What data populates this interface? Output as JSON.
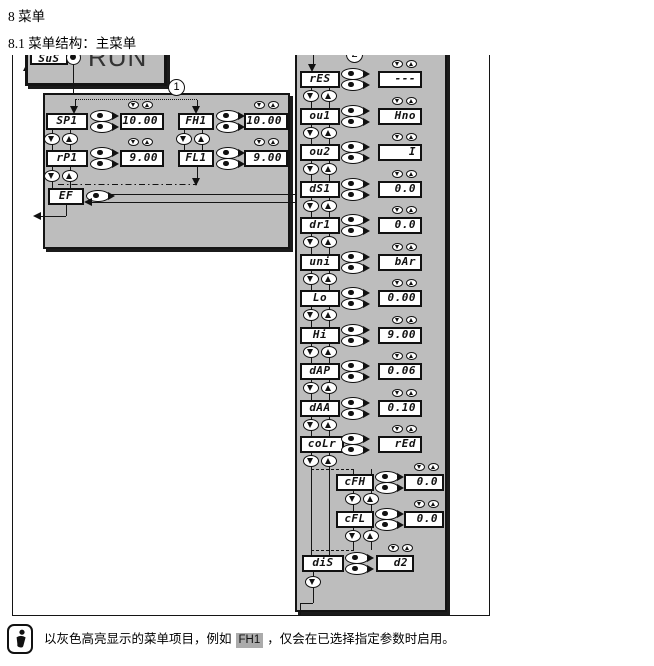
{
  "page": {
    "heading1": "8 菜单",
    "heading2": "8.1 菜单结构：主菜单"
  },
  "diagram": {
    "run_screen": {
      "menu_label": "SuS",
      "display": "RUN"
    },
    "callouts": {
      "one": "1",
      "two": "2"
    },
    "init_menu": {
      "rows": [
        {
          "label": "SP1",
          "value": "10.00"
        },
        {
          "label": "FH1",
          "value": "10.00"
        },
        {
          "label": "rP1",
          "value": "9.00"
        },
        {
          "label": "FL1",
          "value": "9.00"
        }
      ],
      "ef_label": "EF"
    },
    "ext_menu": {
      "rows": [
        {
          "label": "rES",
          "value": "---"
        },
        {
          "label": "ou1",
          "value": "Hno"
        },
        {
          "label": "ou2",
          "value": "I"
        },
        {
          "label": "dS1",
          "value": "0.0"
        },
        {
          "label": "dr1",
          "value": "0.0"
        },
        {
          "label": "uni",
          "value": "bAr"
        },
        {
          "label": "Lo",
          "value": "0.00"
        },
        {
          "label": "Hi",
          "value": "9.00"
        },
        {
          "label": "dAP",
          "value": "0.06"
        },
        {
          "label": "dAA",
          "value": "0.10"
        },
        {
          "label": "coLr",
          "value": "rEd"
        }
      ],
      "sub_rows": [
        {
          "label": "cFH",
          "value": "0.0"
        },
        {
          "label": "cFL",
          "value": "0.0"
        }
      ],
      "dis_row": {
        "label": "diS",
        "value": "d2"
      }
    }
  },
  "note": {
    "text_before": "以灰色高亮显示的菜单项目，例如",
    "highlighted_item": "FH1",
    "text_after": "，仅会在已选择指定参数时启用。"
  },
  "colors": {
    "panel_gray": "#bdbdbd",
    "highlight_gray": "#ababab",
    "line": "#141414"
  }
}
